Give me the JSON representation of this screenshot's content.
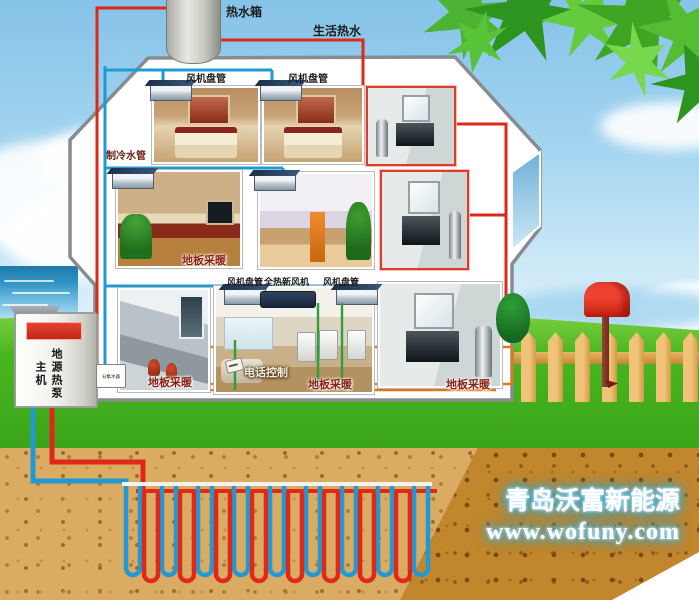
{
  "labels": {
    "tank": "热水箱",
    "dhw": "生活热水",
    "fc1": "风机盘管",
    "fc2": "风机盘管",
    "chilled": "制冷水管",
    "fh1": "地板采暖",
    "fc3": "风机盘管",
    "fresh_air": "全热新风机",
    "fc4": "风机盘管",
    "phone": "电话控制",
    "fh2": "地板采暖",
    "fh3": "地板采暖",
    "fh4": "地板采暖",
    "pump": "地源热泵主机",
    "manifold": "分集水器"
  },
  "branding": {
    "company": "青岛沃富新能源",
    "website": "www.wofuny.com"
  },
  "colors": {
    "hot_pipe": "#e02818",
    "cold_pipe": "#1f9ad6",
    "floor_pipe": "#e07818",
    "branch_pipe": "#2f9e3c",
    "grass": "#49b61f",
    "soil": "#d9ab63"
  }
}
